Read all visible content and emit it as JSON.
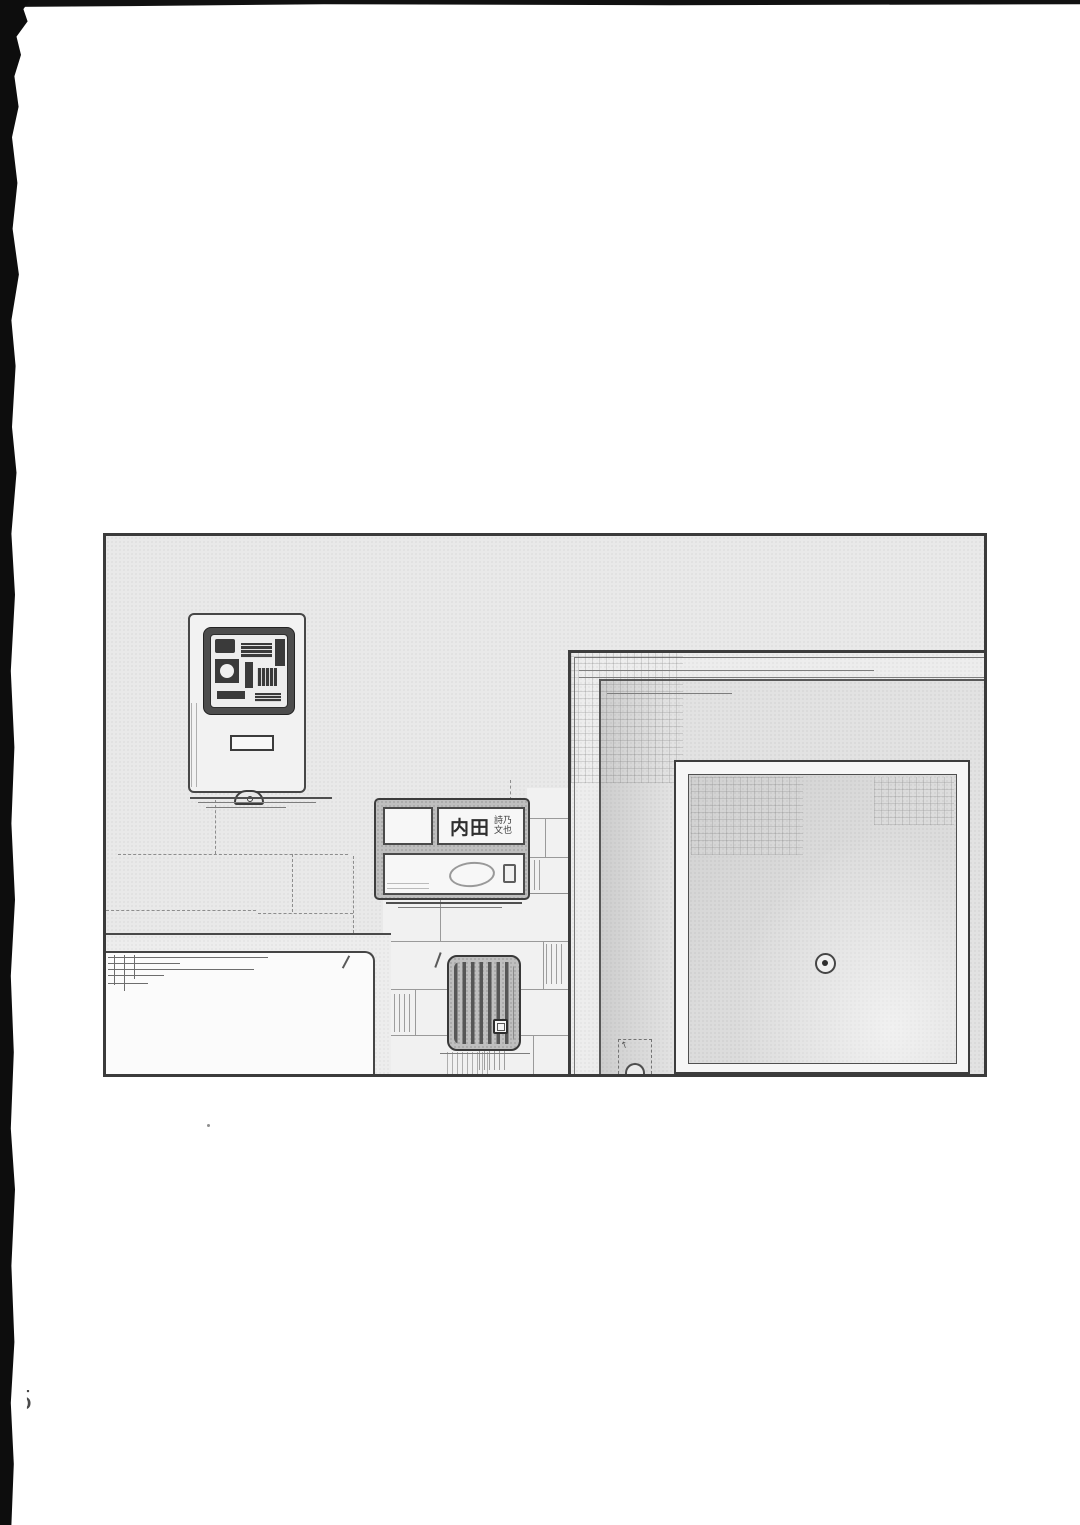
{
  "page": {
    "kind": "manga-page-scan",
    "bg_color": "#ffffff",
    "page_number_partial": "5",
    "artifact_labels": {
      "left_edge": "torn-black-scan-edge",
      "top_edge": "black-scan-strip"
    }
  },
  "panel": {
    "ink_color": "#3b3b3b",
    "wall_color": "#e9e9e9",
    "door_color": "#dcdcdc",
    "scene": "apartment entrance with door, nameplate, meter box, vent and brick wall",
    "nameplate": {
      "family_name": "内田",
      "given_name_top": "詩乃",
      "given_name_bottom": "文也"
    }
  }
}
